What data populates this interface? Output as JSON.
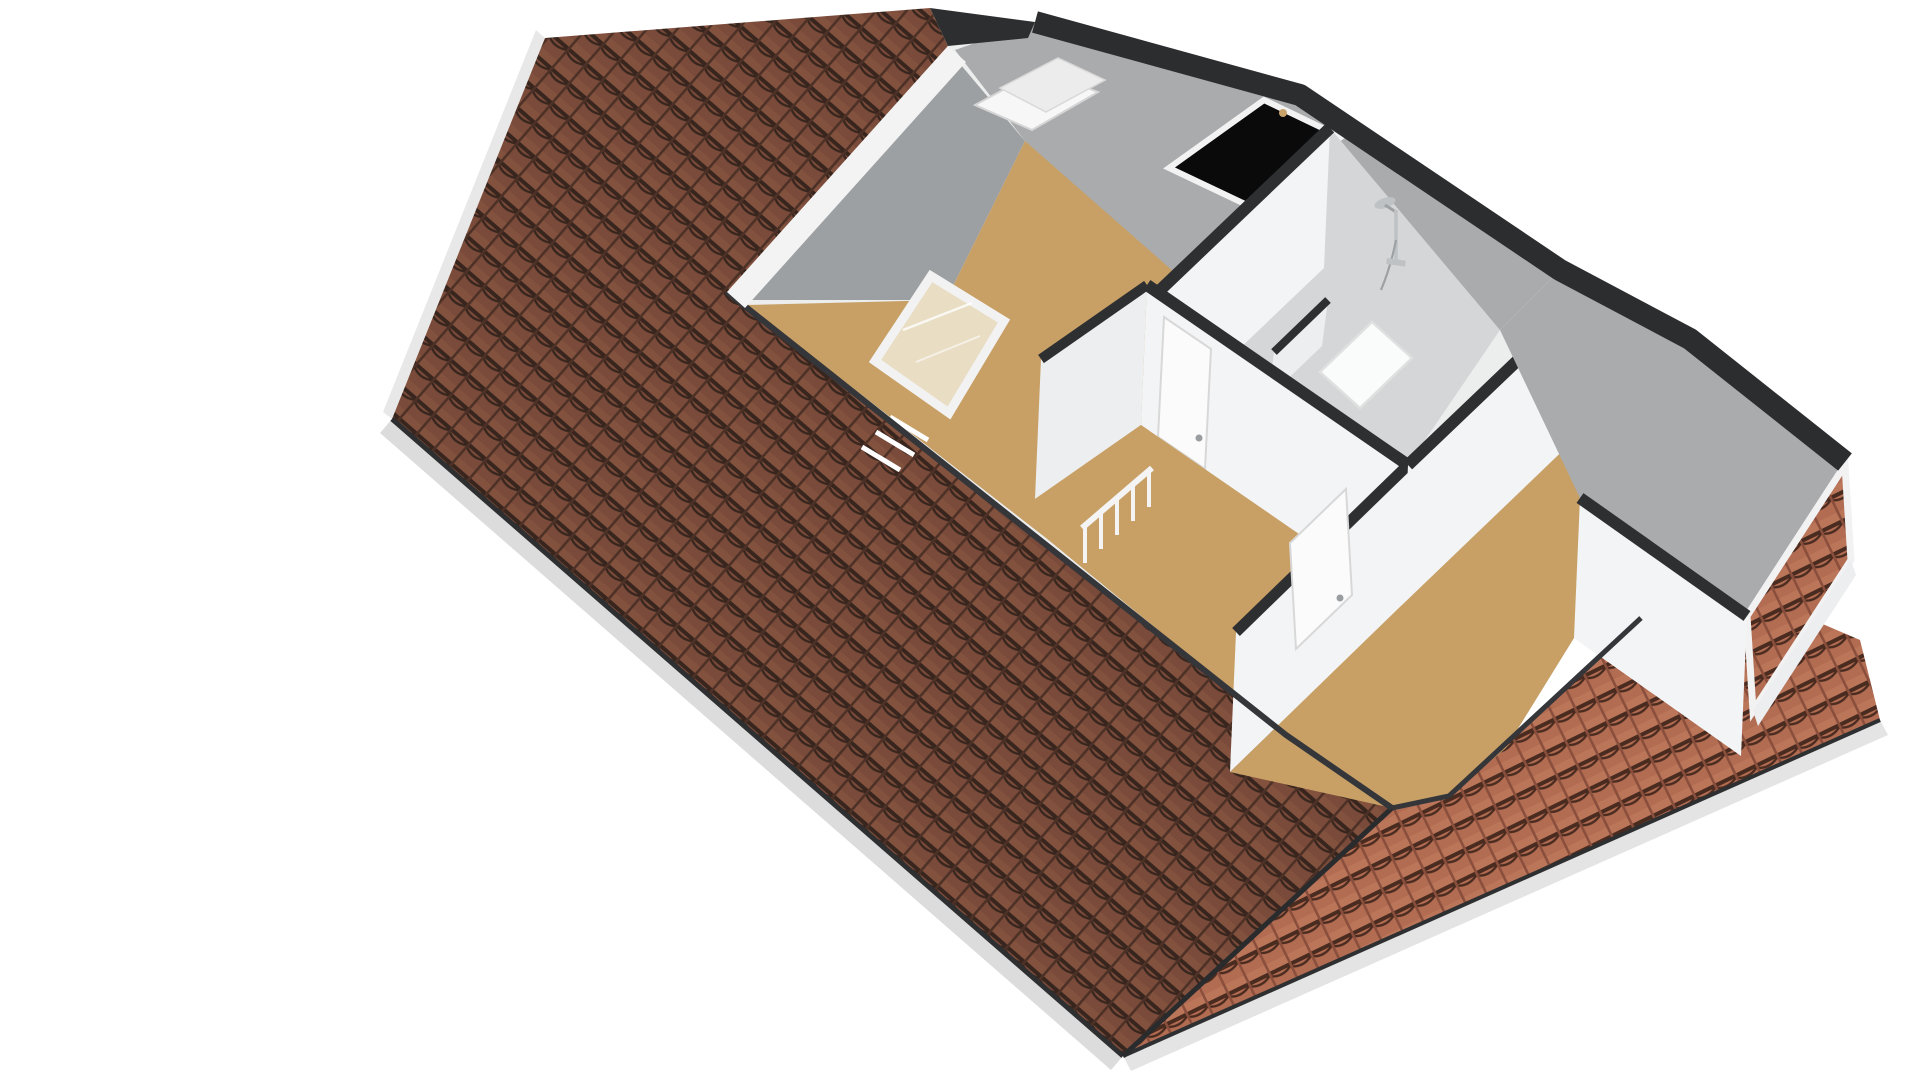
{
  "scene": {
    "title": "attic-floor-3d-floorplan-render",
    "type": "isometric cutaway floor plan, bird's-eye view, no visible text",
    "background": "#ffffff",
    "rooms": [
      "bedroom-left",
      "landing-hallway",
      "shower-room",
      "bedroom-right"
    ],
    "features": [
      "front-roof-slope-dark-tiles",
      "right-roof-slope-light-tiles",
      "gable-tile-overhang",
      "white-ridge-board",
      "open-roof-window",
      "black-roof-window-with-hinges",
      "gray-ceiling-slope-panels",
      "stairwell-opening-with-white-frame",
      "stair-railing",
      "interior-doors-with-handles",
      "shower-fixture",
      "shower-tray",
      "shower-partition-stub",
      "dormer-with-window",
      "eaves-fascia-and-gutter"
    ]
  },
  "colors": {
    "bg": "#ffffff",
    "roof_dark_base": "#7a4b3a",
    "roof_dark_gap": "#38261e",
    "roof_dark_rib": "#4e3126",
    "roof_dark_hi": "#8a5743",
    "roof_light_base": "#b26c52",
    "roof_light_gap": "#4a2b20",
    "roof_light_rib": "#8a4f3c",
    "roof_light_hi": "#c27e61",
    "fascia": "#dcdcdc",
    "fascia_right": "#e4e4e4",
    "rake_fascia": "#e8e8e8",
    "gutter": "#2e2f31",
    "cut_edge": "#35363a",
    "band": "#2c2d2f",
    "interior_base": "#eceded",
    "wall_white": "#f3f4f5",
    "wall_white_dim": "#eceeef",
    "wall_top": "#2e2f31",
    "slope_gray": "#a9abad",
    "gable_gray": "#9da0a2",
    "bath_gray": "#d5d6d8",
    "floor_tan": "#c8a066",
    "stair_fill": "#e9ddc4",
    "frame_white": "#f2f2f2",
    "door_white": "#fbfbfc",
    "door_edge": "#d8d8d8",
    "handle_gray": "#9a9da0",
    "window_black": "#0a0a0b",
    "hinge_gold": "#caa36a",
    "chrome": "#bfc2c4",
    "chrome_dark": "#9ea1a3",
    "tray_white": "#fafbfb",
    "tray_edge": "#e0e0e0",
    "ridge_cap": "#2d2e30",
    "strip_white": "#f3f3f3",
    "sky_frame": "#f7f7f7",
    "sky_sash": "#ececec",
    "valley": "#2a2b2d"
  }
}
